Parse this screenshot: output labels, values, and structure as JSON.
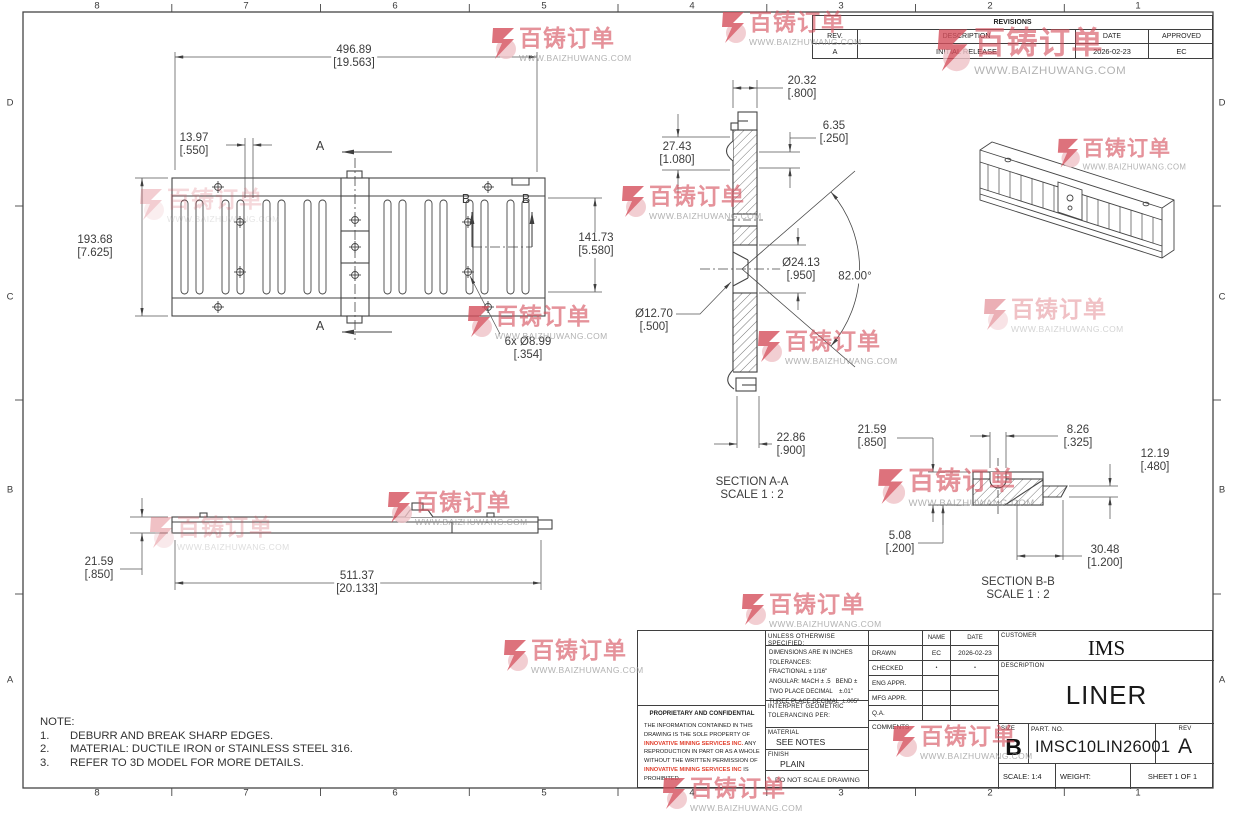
{
  "sheet": {
    "cols": [
      "8",
      "7",
      "6",
      "5",
      "4",
      "3",
      "2",
      "1"
    ],
    "rows": [
      "D",
      "C",
      "B",
      "A"
    ]
  },
  "watermark": {
    "brand": "百铸订单",
    "url": "WWW.BAIZHUWANG.COM"
  },
  "colors": {
    "line": "#454545",
    "watermark_red": "#d54f5c",
    "proprietary_red": "#e2402e"
  },
  "revisions": {
    "title": "REVISIONS",
    "headers": {
      "rev": "REV.",
      "description": "DESCRIPTION",
      "date": "DATE",
      "approved": "APPROVED"
    },
    "rows": [
      {
        "rev": "A",
        "description": "INITIAL RELEASE",
        "date": "2026-02-23",
        "approved": "EC"
      }
    ]
  },
  "views": {
    "labels": {
      "a": "A",
      "b": "B"
    },
    "section_aa": {
      "title": "SECTION A-A",
      "scale": "SCALE 1 : 2"
    },
    "section_bb": {
      "title": "SECTION B-B",
      "scale": "SCALE 1 : 2"
    }
  },
  "dims": {
    "top_length": {
      "mm": "496.89",
      "in": "[19.563]"
    },
    "rib_width": {
      "mm": "13.97",
      "in": "[.550]"
    },
    "height": {
      "mm": "193.68",
      "in": "[7.625]"
    },
    "inner_height": {
      "mm": "141.73",
      "in": "[5.580]"
    },
    "holes": {
      "mm": "6x Ø8.99",
      "in": "[.354]"
    },
    "aa_width": {
      "mm": "20.32",
      "in": "[.800]"
    },
    "aa_top": {
      "mm": "27.43",
      "in": "[1.080]"
    },
    "aa_lip": {
      "mm": "6.35",
      "in": "[.250]"
    },
    "aa_hole": {
      "mm": "Ø24.13",
      "in": "[.950]"
    },
    "aa_angle": {
      "mm": "82.00°",
      "in": ""
    },
    "aa_hole2": {
      "mm": "Ø12.70",
      "in": "[.500]"
    },
    "aa_bottom": {
      "mm": "22.86",
      "in": "[.900]"
    },
    "side_thickness": {
      "mm": "21.59",
      "in": "[.850]"
    },
    "side_length": {
      "mm": "511.37",
      "in": "[20.133]"
    },
    "bb_left": {
      "mm": "21.59",
      "in": "[.850]"
    },
    "bb_slot": {
      "mm": "8.26",
      "in": "[.325]"
    },
    "bb_right": {
      "mm": "12.19",
      "in": "[.480]"
    },
    "bb_step": {
      "mm": "5.08",
      "in": "[.200]"
    },
    "bb_length": {
      "mm": "30.48",
      "in": "[1.200]"
    }
  },
  "notes": {
    "title": "NOTE:",
    "items": [
      {
        "num": "1.",
        "text": "DEBURR AND BREAK SHARP EDGES."
      },
      {
        "num": "2.",
        "text": "MATERIAL: DUCTILE IRON or STAINLESS STEEL 316."
      },
      {
        "num": "3.",
        "text": "REFER TO 3D MODEL FOR MORE DETAILS."
      }
    ]
  },
  "title_block": {
    "tolerances": {
      "header": "UNLESS OTHERWISE SPECIFIED:",
      "lines": [
        "DIMENSIONS ARE IN INCHES",
        "TOLERANCES:",
        "FRACTIONAL ± 1/16\"",
        "ANGULAR: MACH ± .5   BEND ±",
        "TWO PLACE DECIMAL    ±.01\"",
        "THREE PLACE DECIMAL  ±.005\""
      ],
      "interpret": "INTERPRET GEOMETRIC TOLERANCING PER:",
      "material_label": "MATERIAL",
      "material_value": "SEE NOTES",
      "finish_label": "FINISH",
      "finish_value": "PLAIN",
      "do_not_scale": "DO NOT SCALE DRAWING"
    },
    "approvals": {
      "name_header": "NAME",
      "date_header": "DATE",
      "rows": [
        {
          "label": "DRAWN",
          "name": "EC",
          "date": "2026-02-23"
        },
        {
          "label": "CHECKED",
          "name": "•",
          "date": "•"
        },
        {
          "label": "ENG APPR.",
          "name": "",
          "date": ""
        },
        {
          "label": "MFG APPR.",
          "name": "",
          "date": ""
        },
        {
          "label": "Q.A.",
          "name": "",
          "date": ""
        }
      ],
      "comments_label": "COMMENTS"
    },
    "proprietary": {
      "title": "PROPRIETARY AND CONFIDENTIAL",
      "p1": "THE INFORMATION CONTAINED IN THIS DRAWING IS THE SOLE PROPERTY OF ",
      "company1": "INNOVATIVE MINING SERVICES INC.",
      "p2": "  ANY REPRODUCTION IN PART OR AS A WHOLE WITHOUT THE WRITTEN PERMISSION OF ",
      "company2": "INNOVATIVE MINING SERVICES INC",
      "p3": " IS PROHIBITED."
    },
    "info": {
      "customer_label": "CUSTOMER",
      "customer": "IMS",
      "description_label": "DESCRIPTION",
      "description": "LINER",
      "size_label": "SIZE",
      "size": "B",
      "part_label": "PART.  NO.",
      "part_no": "IMSC10LIN26001",
      "rev_label": "REV",
      "rev": "A",
      "scale": "SCALE: 1:4",
      "weight": "WEIGHT:",
      "sheet": "SHEET 1 OF 1"
    }
  }
}
